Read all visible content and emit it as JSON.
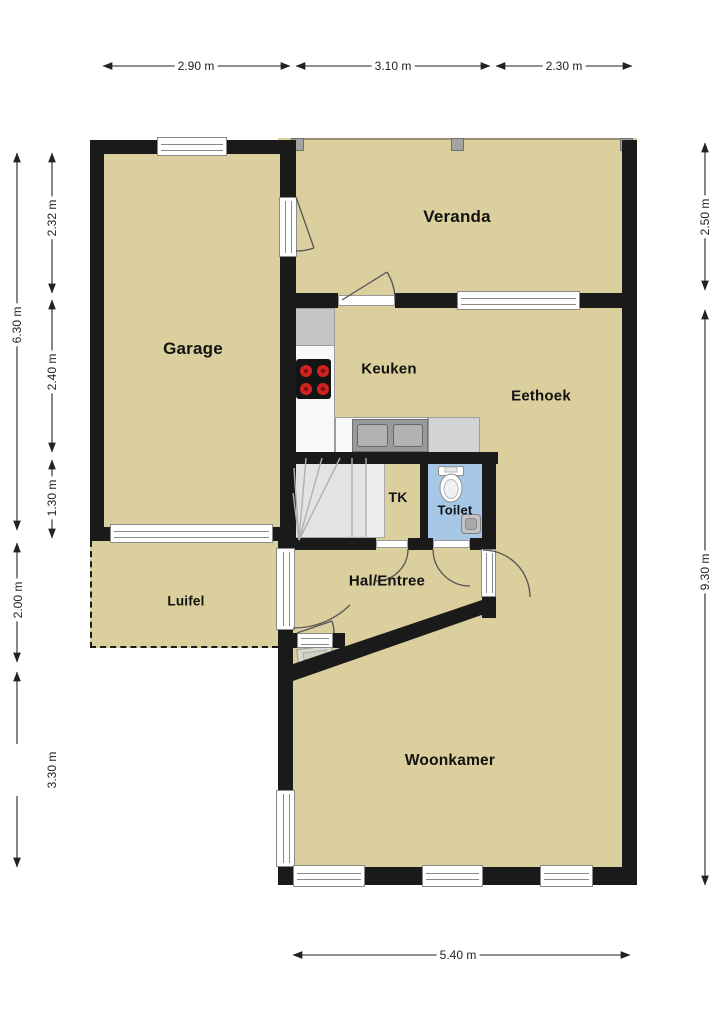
{
  "plan": {
    "rooms": {
      "garage": "Garage",
      "veranda": "Veranda",
      "keuken": "Keuken",
      "eethoek": "Eethoek",
      "tk": "TK",
      "toilet": "Toilet",
      "hal": "Hal/Entree",
      "luifel": "Luifel",
      "woonkamer": "Woonkamer"
    },
    "dimensions": {
      "top": {
        "d1": "2.90 m",
        "d2": "3.10 m",
        "d3": "2.30 m"
      },
      "left_outer": {
        "total": "6.30 m",
        "d4": "2.00 m",
        "d5": "3.30 m"
      },
      "left_inner": {
        "d1": "2.32 m",
        "d2": "2.40 m",
        "d3": "1.30 m"
      },
      "right": {
        "d1": "2.50 m",
        "d2": "9.30 m"
      },
      "bottom": {
        "d1": "5.40 m"
      }
    },
    "colors": {
      "floor": "#dbcf9e",
      "wall": "#1a1a1a",
      "toilet_floor": "#a6c7e6",
      "stairs": "#e3e3e3",
      "counter": "#f8f8f8",
      "burner": "#d32222",
      "background": "#ffffff"
    }
  }
}
